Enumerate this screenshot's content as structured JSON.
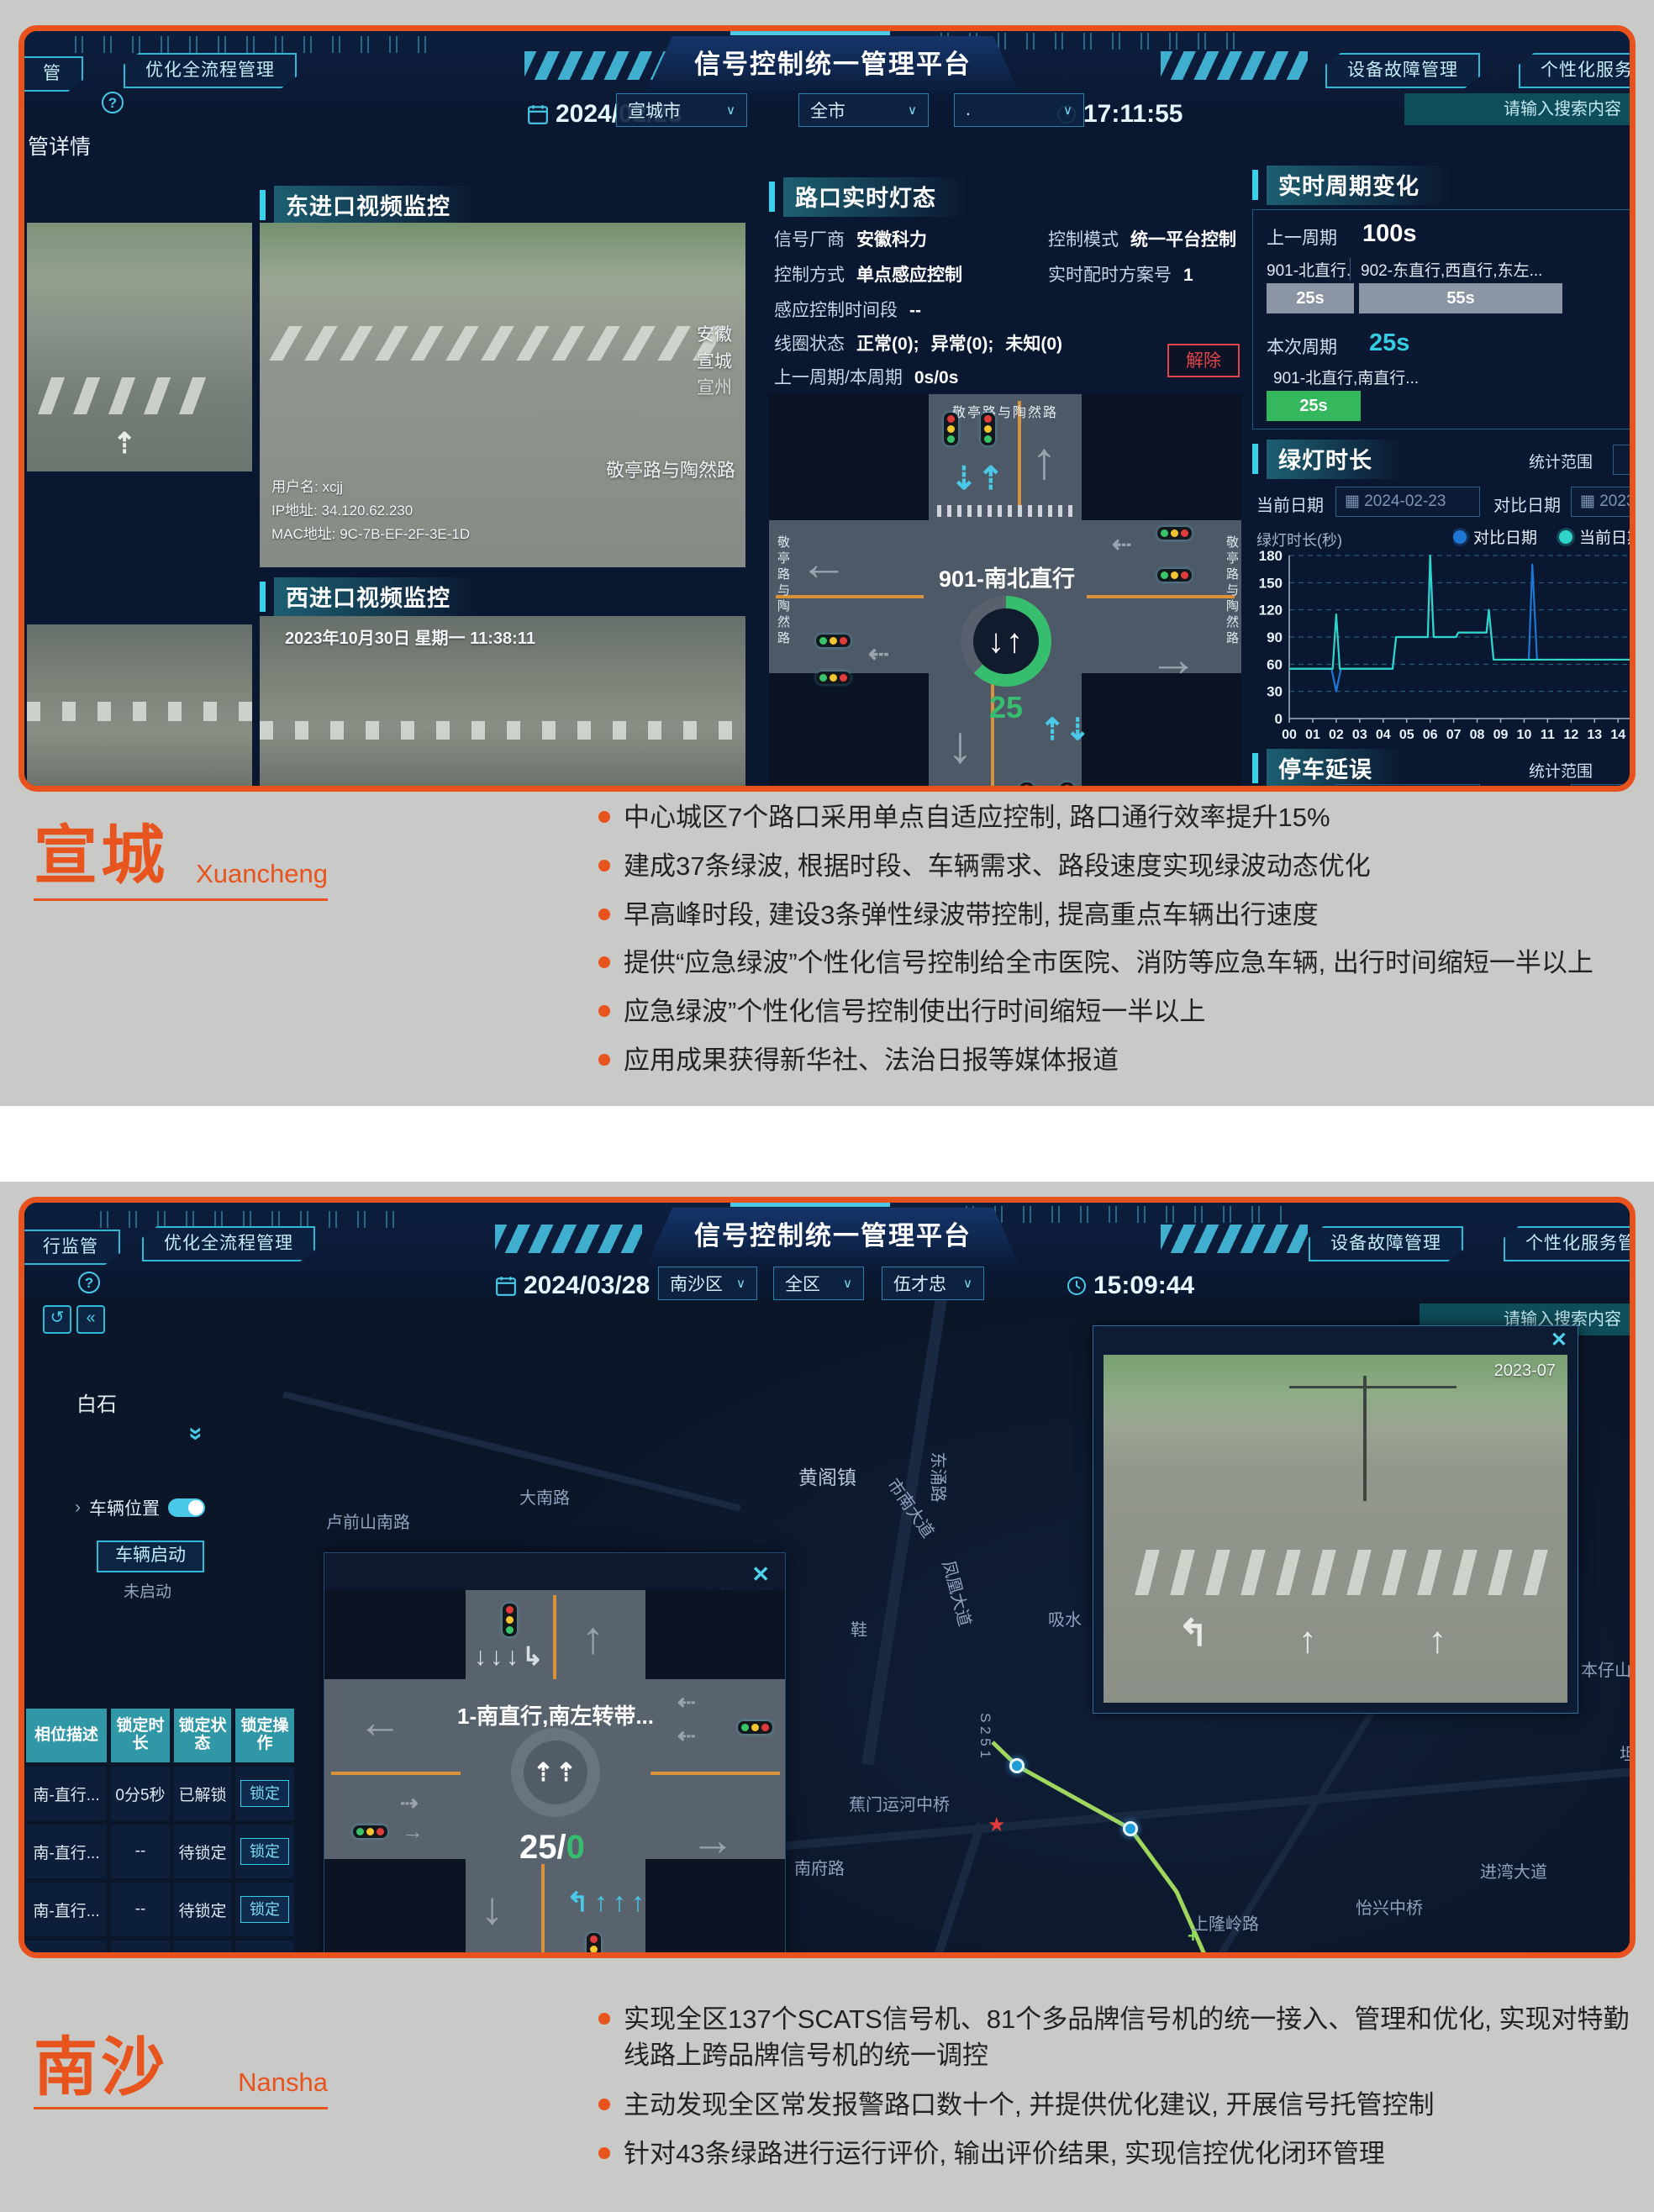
{
  "dash1": {
    "header": {
      "nav_left_partial": "管",
      "nav_left": "优化全流程管理",
      "date": "2024/02/23",
      "title": "信号控制统一管理平台",
      "time": "17:11:55",
      "nav_right1": "设备故障管理",
      "nav_right2": "个性化服务管理",
      "dd_city": "宣城市",
      "dd_area": "全市",
      "dd_third": ".",
      "search_placeholder": "请输入搜索内容",
      "help_icon": "?",
      "breadcrumb_partial": "管详情"
    },
    "video_east": {
      "title": "东进口视频监控",
      "overlay_user": "用户名: xcjj",
      "overlay_ip": "IP地址: 34.120.62.230",
      "overlay_mac": "MAC地址: 9C-7B-EF-2F-3E-1D",
      "loc1": "安徽",
      "loc2": "宣城",
      "loc3": "宣州",
      "loc_road": "敬亭路与陶然路"
    },
    "video_west": {
      "title": "西进口视频监控",
      "timestamp": "2023年10月30日 星期一  11:38:11"
    },
    "light_panel": {
      "title": "路口实时灯态",
      "vendor_label": "信号厂商",
      "vendor": "安徽科力",
      "mode_label": "控制模式",
      "mode": "统一平台控制",
      "method_label": "控制方式",
      "method": "单点感应控制",
      "plan_label": "实时配时方案号",
      "plan": "1",
      "period_label": "感应控制时间段",
      "period": "--",
      "coil_label": "线圈状态",
      "coil_ok": "正常(0);",
      "coil_err": "异常(0);",
      "coil_unknown": "未知(0)",
      "cycle_label": "上一周期/本周期",
      "cycle_prev": "0s/",
      "cycle_now": "0s",
      "release_btn": "解除",
      "junction_label": "901-南北直行",
      "countdown": "25",
      "center_arrows": "↓↑",
      "road_top": "敬亭路与陶然路",
      "road_left": "敬亭路与陶然路",
      "road_right": "敬亭路与陶然路"
    },
    "cycle_panel": {
      "title": "实时周期变化",
      "prev_label": "上一周期",
      "prev_value": "100s",
      "seg1_label": "901-北直行...",
      "seg2_label": "902-东直行,西直行,东左...",
      "seg1_time": "25s",
      "seg2_time": "55s",
      "cur_label": "本次周期",
      "cur_value": "25s",
      "cur_seg_label": "901-北直行,南直行...",
      "cur_seg_time": "25s"
    },
    "green_panel": {
      "title": "绿灯时长",
      "stat_label": "统计范围",
      "date_label": "当前日期",
      "date_value": "2024-02-23",
      "cmp_label": "对比日期",
      "cmp_value": "2023-"
    },
    "delay_panel": {
      "title": "停车延误",
      "stat_label": "统计范围",
      "date_label": "当前日期",
      "date_value": "2024-02-23",
      "cmp_label": "对比日期",
      "cmp_value": "2023-"
    }
  },
  "chart_data": {
    "type": "line",
    "title": "绿灯时长",
    "ylabel": "绿灯时长(秒)",
    "ylim": [
      0,
      180
    ],
    "yticks": [
      0,
      30,
      60,
      90,
      120,
      150,
      180
    ],
    "xticks": [
      "00",
      "01",
      "02",
      "03",
      "04",
      "05",
      "06",
      "07",
      "08",
      "09",
      "10",
      "11",
      "12",
      "13",
      "14"
    ],
    "xlim": [
      0,
      14.6
    ],
    "grid": true,
    "legend_position": "top-right",
    "series": [
      {
        "name": "对比日期",
        "color": "#1f77d4",
        "points": [
          [
            0,
            55
          ],
          [
            1.8,
            55
          ],
          [
            2,
            30
          ],
          [
            2.2,
            55
          ],
          [
            4.4,
            55
          ],
          [
            4.55,
            90
          ],
          [
            5.9,
            90
          ],
          [
            6,
            175
          ],
          [
            6.15,
            90
          ],
          [
            7.1,
            90
          ],
          [
            7.2,
            95
          ],
          [
            8.4,
            95
          ],
          [
            8.5,
            120
          ],
          [
            8.7,
            65
          ],
          [
            10.2,
            65
          ],
          [
            10.35,
            170
          ],
          [
            10.55,
            65
          ],
          [
            14.6,
            65
          ]
        ]
      },
      {
        "name": "当前日期",
        "color": "#2fd5c8",
        "points": [
          [
            0,
            55
          ],
          [
            1.85,
            55
          ],
          [
            2,
            115
          ],
          [
            2.15,
            55
          ],
          [
            4.4,
            55
          ],
          [
            4.55,
            90
          ],
          [
            5.9,
            90
          ],
          [
            6,
            180
          ],
          [
            6.15,
            90
          ],
          [
            7.1,
            90
          ],
          [
            7.2,
            95
          ],
          [
            8.4,
            95
          ],
          [
            8.5,
            120
          ],
          [
            8.7,
            65
          ],
          [
            14.6,
            65
          ]
        ]
      }
    ]
  },
  "xuancheng": {
    "title": "宣城",
    "subtitle": "Xuancheng",
    "bullets": [
      "中心城区7个路口采用单点自适应控制, 路口通行效率提升15%",
      "建成37条绿波, 根据时段、车辆需求、路段速度实现绿波动态优化",
      "早高峰时段, 建设3条弹性绿波带控制, 提高重点车辆出行速度",
      "提供“应急绿波”个性化信号控制给全市医院、消防等应急车辆, 出行时间缩短一半以上",
      "应急绿波”个性化信号控制使出行时间缩短一半以上",
      "应用成果获得新华社、法治日报等媒体报道"
    ]
  },
  "dash2": {
    "header": {
      "nav_left_partial": "行监管",
      "nav_left": "优化全流程管理",
      "date": "2024/03/28",
      "title": "信号控制统一管理平台",
      "time": "15:09:44",
      "nav_right1": "设备故障管理",
      "nav_right2": "个性化服务管理",
      "dd_district": "南沙区",
      "dd_area": "全区",
      "dd_user": "伍才忠",
      "search_placeholder": "请输入搜索内容",
      "help_icon": "?"
    },
    "sidebar": {
      "back_icon": "↺",
      "collapse_icon": "«",
      "expand_icon": "»",
      "vehicle_toggle_label": "车辆位置",
      "vehicle_toggle_caret": "›",
      "start_btn": "车辆启动",
      "start_status": "未启动"
    },
    "table": {
      "headers": [
        "相位描述",
        "锁定时长",
        "锁定状态",
        "锁定操作"
      ],
      "rows": [
        {
          "phase": "南-直行...",
          "dur": "0分5秒",
          "state": "已解锁",
          "op": "锁定"
        },
        {
          "phase": "南-直行...",
          "dur": "--",
          "state": "待锁定",
          "op": "锁定"
        },
        {
          "phase": "南-直行...",
          "dur": "--",
          "state": "待锁定",
          "op": "锁定"
        },
        {
          "phase": "北-直行...",
          "dur": "--",
          "state": "待锁定",
          "op": "锁定"
        }
      ]
    },
    "popup": {
      "close": "✕",
      "junction_label": "1-南直行,南左转带...",
      "countdown_white": "25/",
      "countdown_green": "0"
    },
    "cam": {
      "close": "✕",
      "label": "2023-07"
    },
    "map": {
      "labels": [
        {
          "t": "白石",
          "x": 62,
          "y": 108,
          "s": 24,
          "c": "#e8eef4"
        },
        {
          "t": "黄阁镇",
          "x": 921,
          "y": 196,
          "s": 23,
          "c": "#b8c6da"
        },
        {
          "t": "大南路",
          "x": 589,
          "y": 223
        },
        {
          "t": "卢前山南路",
          "x": 359,
          "y": 252
        },
        {
          "t": "东涌路",
          "x": 1059,
          "y": 200,
          "r": 90
        },
        {
          "t": "市南大道",
          "x": 1016,
          "y": 236,
          "r": 55
        },
        {
          "t": "大井山塘",
          "x": 801,
          "y": 336,
          "s": 23,
          "c": "#b3c1d6"
        },
        {
          "t": "凤凰大道",
          "x": 1071,
          "y": 338,
          "r": 75
        },
        {
          "t": "吸水",
          "x": 1218,
          "y": 368
        },
        {
          "t": "鞋",
          "x": 983,
          "y": 380
        },
        {
          "t": "日本仔山",
          "x": 1832,
          "y": 428
        },
        {
          "t": "坦",
          "x": 1898,
          "y": 528
        },
        {
          "t": "S 2 5 1",
          "x": 1116,
          "y": 512,
          "r": 90,
          "s": 17
        },
        {
          "t": "蕉门运河中桥",
          "x": 981,
          "y": 588
        },
        {
          "t": "南府路",
          "x": 916,
          "y": 664
        },
        {
          "t": "进湾大道",
          "x": 1732,
          "y": 668
        },
        {
          "t": "怡兴中桥",
          "x": 1584,
          "y": 711
        },
        {
          "t": "上隆岭路",
          "x": 1389,
          "y": 730
        },
        {
          "t": "双山大道",
          "x": 1242,
          "y": 786
        },
        {
          "t": "凯瑞思大酒店",
          "x": 1537,
          "y": 818,
          "s": 22,
          "c": "#aebcd2"
        },
        {
          "t": "蕉西路",
          "x": 1067,
          "y": 810
        },
        {
          "t": "利丰路",
          "x": 1330,
          "y": 838
        },
        {
          "t": "丰泽东路",
          "x": 1200,
          "y": 862
        },
        {
          "t": "飞云顶",
          "x": 1794,
          "y": 868
        }
      ]
    }
  },
  "nansha": {
    "title": "南沙",
    "subtitle": "Nansha",
    "bullets": [
      "实现全区137个SCATS信号机、81个多品牌信号机的统一接入、管理和优化, 实现对特勤线路上跨品牌信号机的统一调控",
      "主动发现全区常发报警路口数十个, 并提供优化建议, 开展信号托管控制",
      "针对43条绿路进行运行评价, 输出评价结果, 实现信控优化闭环管理"
    ]
  }
}
